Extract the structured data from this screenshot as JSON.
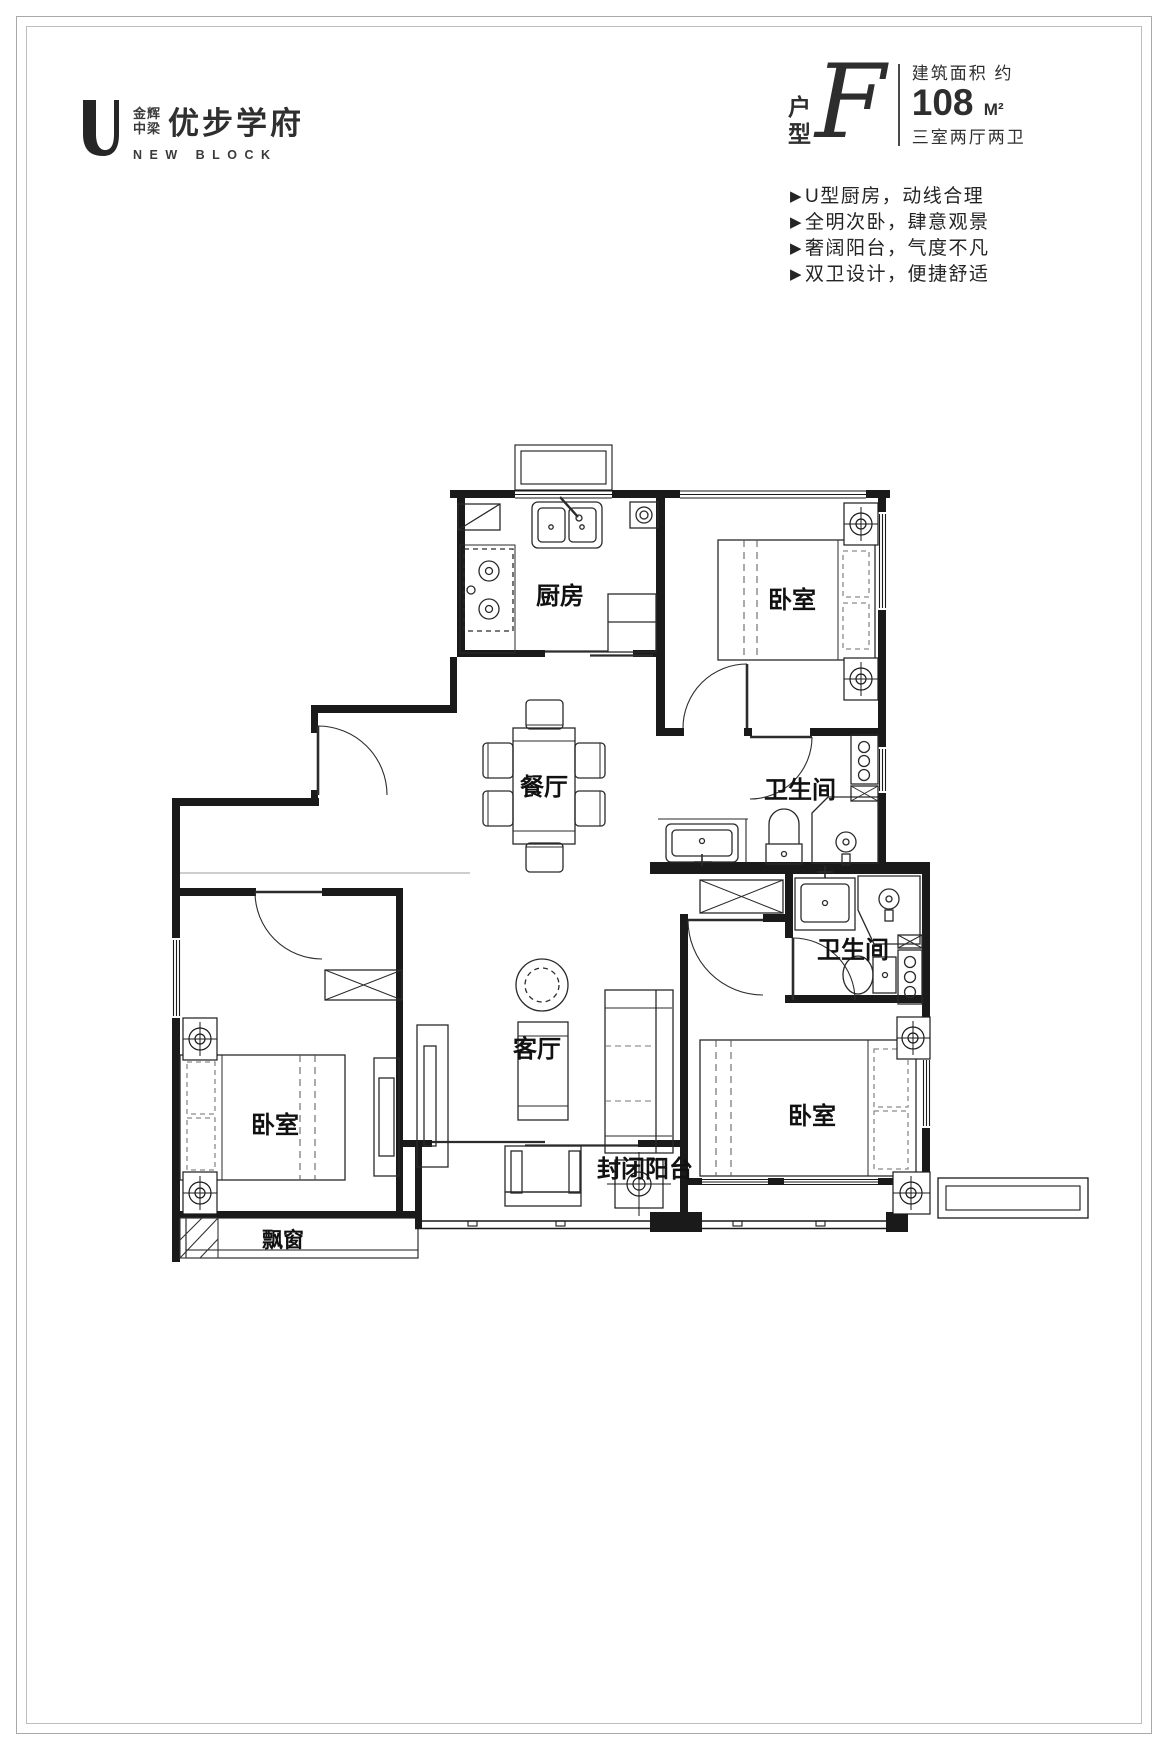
{
  "brand": {
    "logo_mark": "U",
    "logo_cn_line1": "金辉",
    "logo_cn_line2": "中梁",
    "logo_name": "优步学府",
    "logo_en": "NEW BLOCK"
  },
  "unit": {
    "type_char1": "户",
    "type_char2": "型",
    "type_letter": "F",
    "area_label": "建筑面积  约",
    "area_value": "108",
    "area_unit": "M²",
    "layout_desc": "三室两厅两卫"
  },
  "feature_bullet": "▶",
  "features": [
    "U型厨房，动线合理",
    "全明次卧，肆意观景",
    "奢阔阳台，气度不凡",
    "双卫设计，便捷舒适"
  ],
  "rooms": {
    "kitchen": "厨房",
    "bedroom_top": "卧室",
    "dining": "餐厅",
    "bath_top": "卫生间",
    "bath_bottom": "卫生间",
    "living": "客厅",
    "bedroom_left": "卧室",
    "bedroom_right": "卧室",
    "bay_window": "飘窗",
    "balcony": "封闭阳台"
  },
  "colors": {
    "wall": "#1a1a1a",
    "line": "#2a2a2a",
    "frame": "#a9a9a9"
  }
}
